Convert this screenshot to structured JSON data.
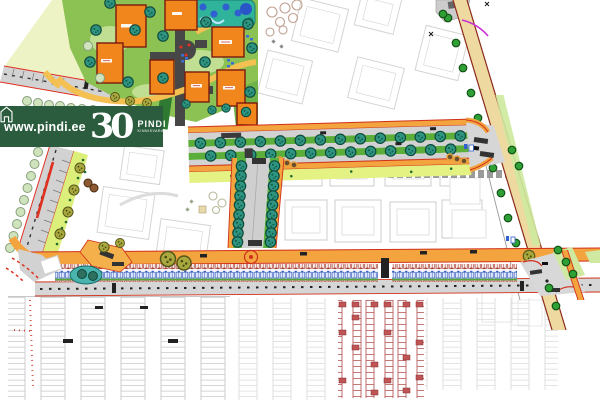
{
  "banner": {
    "website": "www.pindi.ee",
    "anniversary_number": "30",
    "brand_name": "PINDI",
    "brand_subtitle": "KINNISVARA",
    "background_color": "#2b5c3e",
    "text_color": "#ffffff",
    "logo_icon": "house-icon"
  },
  "map": {
    "type": "development-site-plan",
    "palette": {
      "building_orange": "#f0861c",
      "building_outline": "#7a1a0f",
      "lawn_green": "#8cc153",
      "median_green": "#5cae3b",
      "verge_chartreuse": "#e3f283",
      "sidewalk_orange": "#f3a43e",
      "curb_red": "#d0301a",
      "road_gray": "#d2d2d2",
      "asphalt_dark": "#4a4a4a",
      "tree_teal": "#2f9480",
      "tree_olive": "#a8a83e",
      "tree_pale": "#cfe3bd",
      "tree_green": "#2ea036",
      "diagonal_road_tan": "#eed9a1",
      "diagonal_edge_red": "#8c2a1a",
      "rowhouse_blue": "#3b5fc0",
      "rowhouse_red": "#a84038",
      "parking_gray": "#c8c8c8",
      "parking_red": "#b85858",
      "water_teal": "#4ab3ae",
      "plan_faint_gray": "#d8d8d8",
      "marker_magenta": "#c92fd2"
    }
  }
}
